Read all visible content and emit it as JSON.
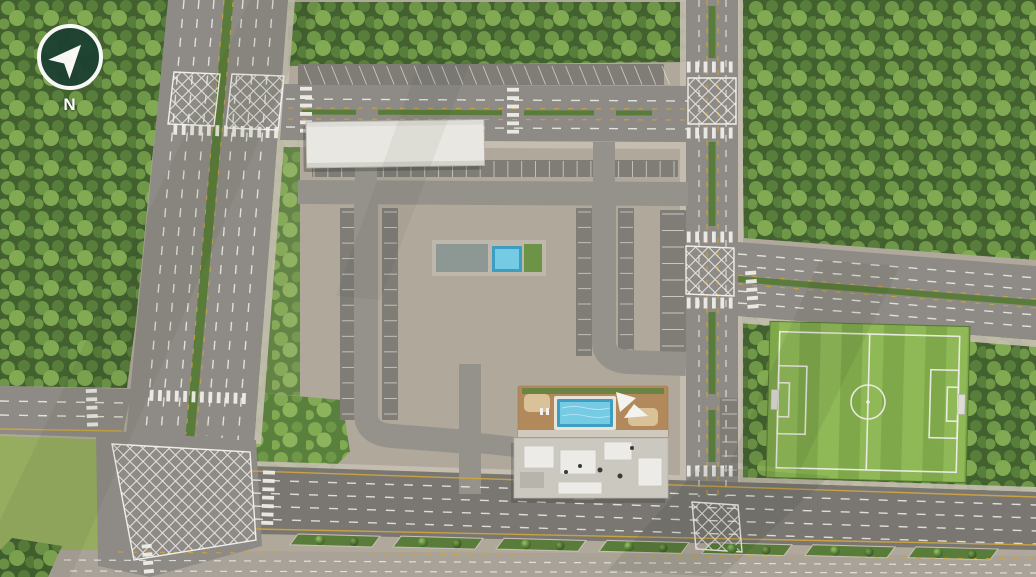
{
  "compass": {
    "label": "N",
    "icon": "navigation-arrow-northeast"
  },
  "scene": {
    "type": "aerial-masterplan-render",
    "features": [
      "townhouse-rows",
      "swimming-pool-deck",
      "clubhouse",
      "soccer-field",
      "divided-avenues",
      "hatched-junctions",
      "forest",
      "parking"
    ]
  },
  "colors": {
    "ground": "#b1a89c",
    "sidewalk": "#c6bfb2",
    "grass": "#96ad60",
    "forest_base": "#42612f",
    "forest_leaf1": "#587e3b",
    "forest_leaf2": "#6e9747",
    "forest_leaf3": "#81aa52",
    "park_base": "#5a803d",
    "road": "#8e8b86",
    "road_dark": "#7a7772",
    "road_light": "#a9a299",
    "drive": "#95928c",
    "lot": "#807d77",
    "median": "#5a7c3a",
    "mark_white": "#f0eeea",
    "mark_yellow": "#d0a63e",
    "field_a": "#7fa84a",
    "field_b": "#8fb957",
    "roof": "#e9e7e1",
    "roof_line": "#cac7bf",
    "skylight": "#f8f8f5",
    "skylight_edge": "#9299a2",
    "club_roof": "#cbc8c0",
    "deck": "#b2895b",
    "sand": "#d9c297",
    "pool_dark": "#3d9ec2",
    "pool_light": "#76cbe4",
    "sail": "#f3f2ee",
    "car_dark": "#2d2e31",
    "car_white": "#efeeec",
    "car_gray": "#94979c",
    "car_blue": "#3f5b9e",
    "car_red": "#8e3a32",
    "tree_hi": "#9cc268",
    "tree_mid": "#558037",
    "tree_dark": "#3f6129",
    "compass_bg": "#1d4131",
    "compass_fg": "#ffffff"
  }
}
